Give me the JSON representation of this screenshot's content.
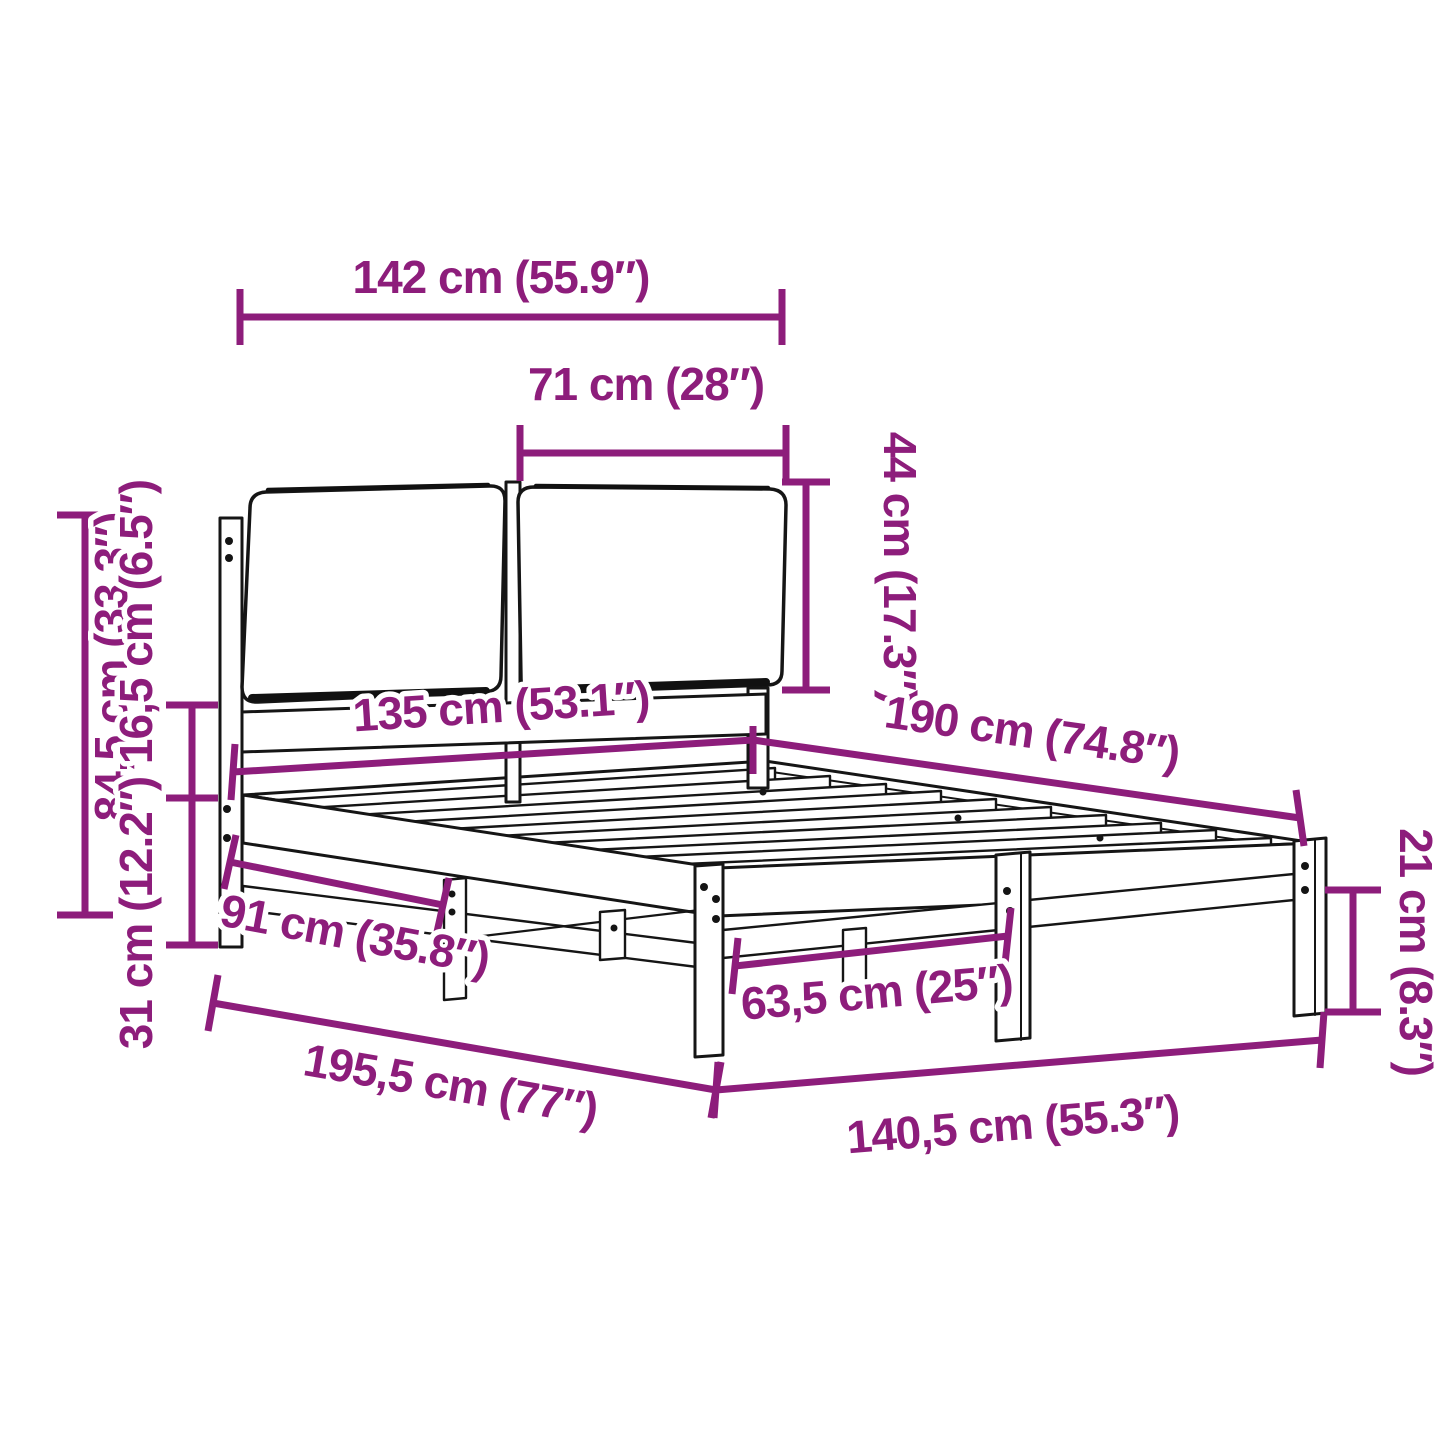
{
  "figure": {
    "kind": "product dimension diagram",
    "subject": "bed frame with two headboard cushions",
    "background": "#ffffff"
  },
  "colors": {
    "dimension_accent": "#8d1d7b",
    "line_art": "#151515"
  },
  "dims": {
    "d142": {
      "label": "142 cm (55.9″)"
    },
    "d71": {
      "label": "71 cm (28″)"
    },
    "d44": {
      "label": "44 cm (17.3″)"
    },
    "d84": {
      "label": "84,5 cm (33.3″)"
    },
    "d165": {
      "label": "16,5 cm (6.5″)"
    },
    "d31": {
      "label": "31 cm (12.2″)"
    },
    "d135": {
      "label": "135 cm (53.1″)"
    },
    "d190": {
      "label": "190 cm (74.8″)"
    },
    "d91": {
      "label": "91 cm (35.8″)"
    },
    "d195": {
      "label": "195,5 cm (77″)"
    },
    "d635": {
      "label": "63,5 cm (25″)"
    },
    "d1405": {
      "label": "140,5 cm (55.3″)"
    },
    "d21": {
      "label": "21 cm (8.3″)"
    }
  }
}
